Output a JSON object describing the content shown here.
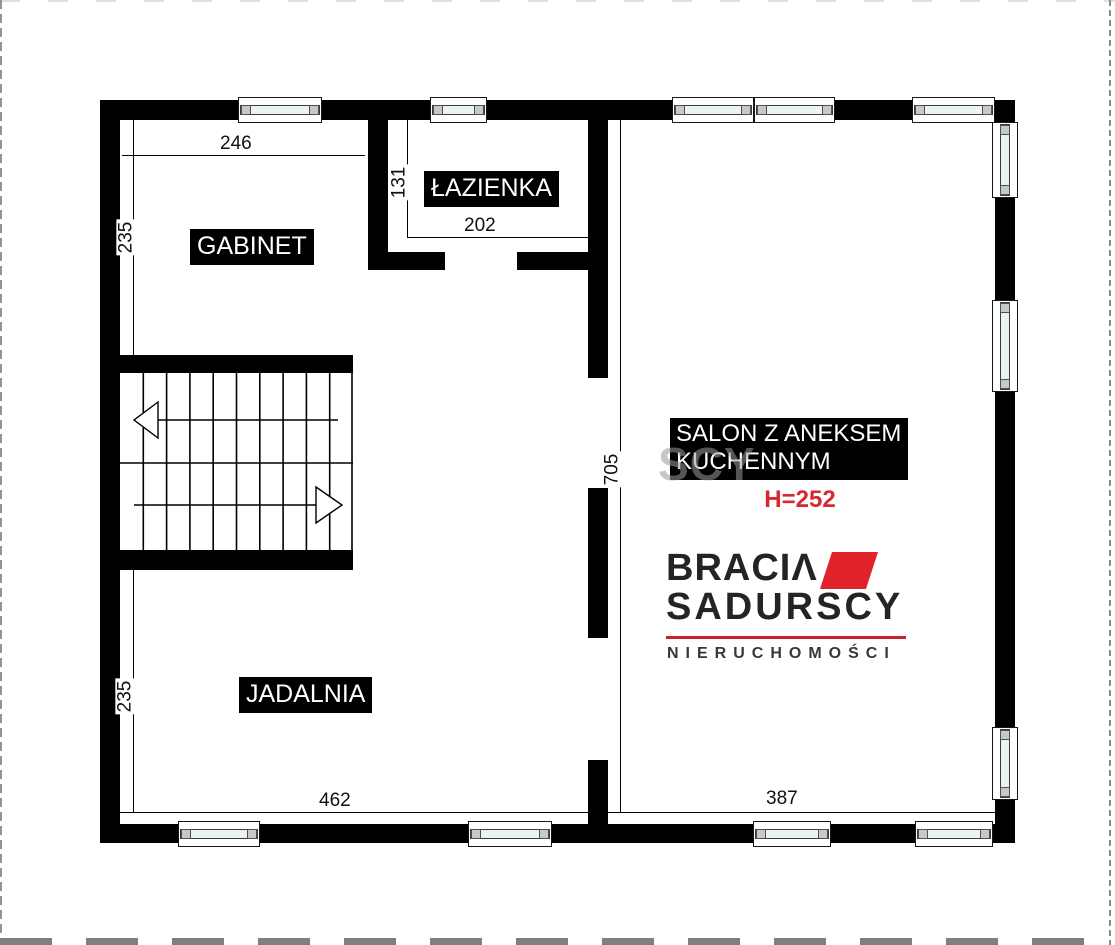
{
  "plan": {
    "rooms": {
      "gabinet": {
        "label": "GABINET",
        "width_cm": "246",
        "height_cm": "235"
      },
      "lazienka": {
        "label": "ŁAZIENKA",
        "width_cm": "202",
        "height_cm": "131"
      },
      "salon": {
        "label_line1": "SALON Z ANEKSEM",
        "label_line2": "KUCHENNYM",
        "ceiling_height": "H=252",
        "height_cm": "705",
        "bottom_width_cm": "387"
      },
      "jadalnia": {
        "label": "JADALNIA",
        "height_cm": "235",
        "bottom_width_cm": "462"
      }
    },
    "colors": {
      "wall": "#000000",
      "window_glass": "#e9f4f5",
      "window_cap": "#c8c8c8",
      "height_note_red": "#d7282f"
    }
  },
  "branding": {
    "line1": "BRACIΛ",
    "line2": "SADURSCY",
    "line3": "NIERUCHOMOŚCI",
    "watermark_fragment": "SCY",
    "accent_red": "#e02329",
    "rule_red": "#c4242b",
    "dark": "#272324"
  }
}
